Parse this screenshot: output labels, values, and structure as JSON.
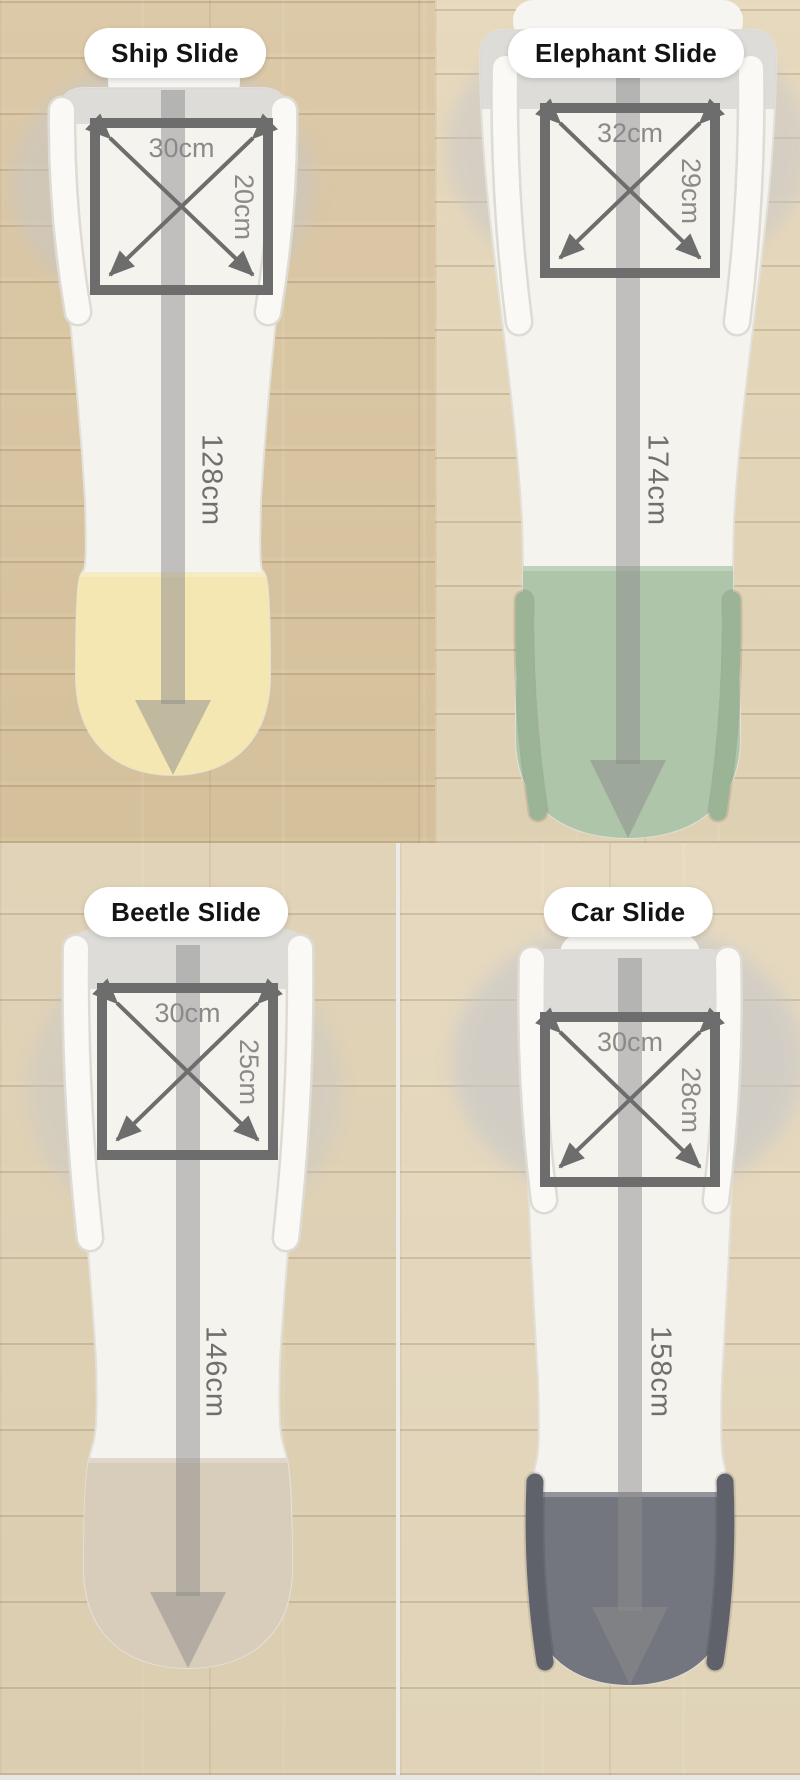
{
  "collage": {
    "slides": [
      {
        "name": "Ship Slide",
        "top_width": "30cm",
        "top_depth": "20cm",
        "length": "128cm",
        "end_color": "#f4e7b2",
        "end_rail_color": "#e7d795"
      },
      {
        "name": "Elephant Slide",
        "top_width": "32cm",
        "top_depth": "29cm",
        "length": "174cm",
        "end_color": "#afc5aa",
        "end_rail_color": "#9bb496"
      },
      {
        "name": "Beetle Slide",
        "top_width": "30cm",
        "top_depth": "25cm",
        "length": "146cm",
        "end_color": "#d8ccbb",
        "end_rail_color": "#cabca7"
      },
      {
        "name": "Car Slide",
        "top_width": "30cm",
        "top_depth": "28cm",
        "length": "158cm",
        "end_color": "#74767f",
        "end_rail_color": "#5f616b"
      }
    ],
    "style": {
      "pill_bg": "#ffffff",
      "pill_text": "#141414",
      "square_border": "#6d6d6d",
      "dim_label_color": "#8a8a8a",
      "length_label_color": "#6f6f6f",
      "measure_arrow_color": "#8c8c8c",
      "slide_body_color": "#f5f3ee",
      "platform_shade": "#d8d7d5",
      "shadow_blob": "#c7c7c9"
    }
  }
}
